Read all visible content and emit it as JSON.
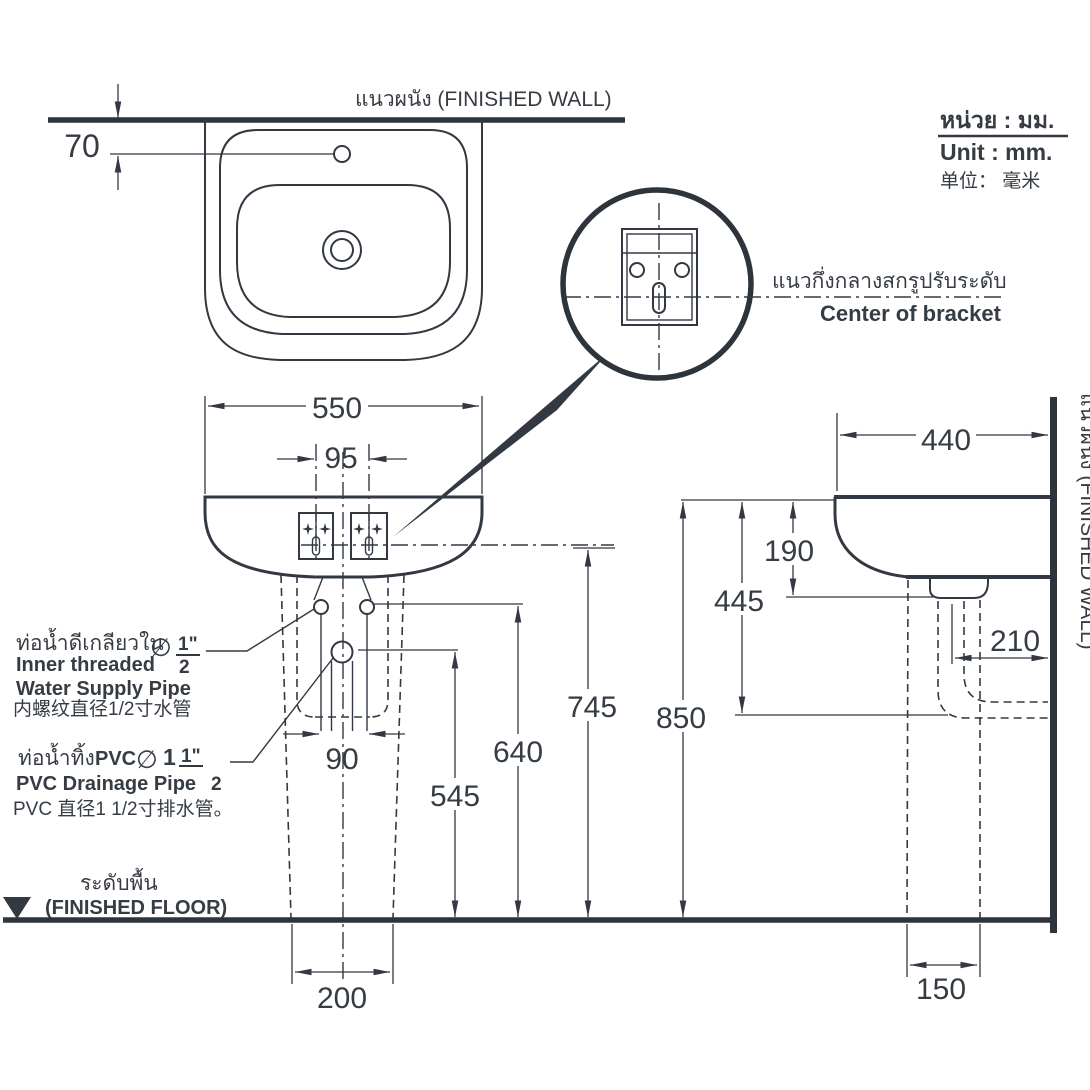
{
  "units": {
    "thai": "หน่วย : มม.",
    "en": "Unit : mm.",
    "cn": "单位： 毫米"
  },
  "plan": {
    "wall_label": "แนวผนัง (FINISHED WALL)",
    "faucet_offset": "70"
  },
  "detail": {
    "thai": "แนวกึ่งกลางสกรูปรับระดับ",
    "en": "Center of bracket"
  },
  "front": {
    "width": "550",
    "bracket_spacing": "95",
    "supply_spacing": "90",
    "drain_height": "545",
    "supply_height": "640",
    "bracket_height": "745",
    "rim_height": "850",
    "pedestal_width": "200"
  },
  "side": {
    "depth": "440",
    "rim_drop": "190",
    "rim_to_outlet": "445",
    "outlet_offset": "210",
    "pedestal_depth": "150",
    "wall_label": "แนวผนัง (FINISHED WALL)"
  },
  "floor": {
    "thai": "ระดับพื้น",
    "en": "(FINISHED FLOOR)"
  },
  "supply_label": {
    "thai": "ท่อน้ำดีเกลียวใน",
    "dia": "∅",
    "num": "1\"",
    "den": "2",
    "en1": "Inner threaded",
    "en2": "Water Supply Pipe",
    "cn": "内螺纹直径1/2寸水管"
  },
  "drain_label": {
    "thai": "ท่อน้ำทิ้ง",
    "pvc": "PVC",
    "dia": "∅",
    "whole": "1",
    "num": "1\"",
    "den": "2",
    "en": "PVC Drainage Pipe",
    "cn": "PVC 直径1 1/2寸排水管。"
  }
}
